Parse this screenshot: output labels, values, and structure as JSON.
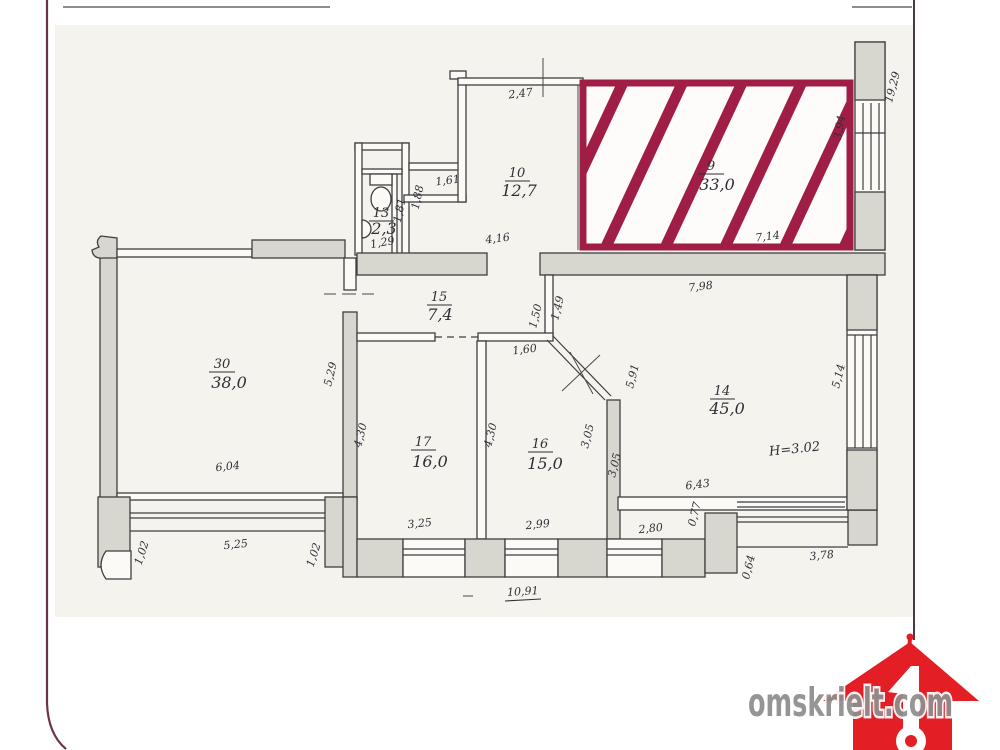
{
  "page": {
    "background": "#ffffff",
    "scan_background": "#f4f3ee"
  },
  "watermark": {
    "text": "omskrielt.com",
    "text_color": "#8e8e8e",
    "house_color": "#e31e24"
  },
  "plan": {
    "highlight_color": "#a01e46",
    "height_note": "H=3.02",
    "rooms": {
      "r9": {
        "number": "9",
        "area": "33,0"
      },
      "r10": {
        "number": "10",
        "area": "12,7"
      },
      "r13": {
        "number": "13",
        "area": "2,3"
      },
      "r15": {
        "number": "15",
        "area": "7,4"
      },
      "r30": {
        "number": "30",
        "area": "38,0"
      },
      "r17": {
        "number": "17",
        "area": "16,0"
      },
      "r16": {
        "number": "16",
        "area": "15,0"
      },
      "r14": {
        "number": "14",
        "area": "45,0"
      }
    },
    "dims": {
      "top_247": "2,47",
      "right_394": "3,94",
      "bottom_714": "7,14",
      "right_1929": "19,29",
      "niche_161": "1,61",
      "niche_188": "1,88",
      "wc_181": "1,81",
      "wc_129": "1,29",
      "hall_416": "4,16",
      "r14_798": "7,98",
      "wall_149": "1,49",
      "wall_150": "1,50",
      "hall_160": "1,60",
      "r14_591": "5,91",
      "r14_514": "5,14",
      "r30_529": "5,29",
      "r17_430l": "4,30",
      "r17_430r": "4,30",
      "r30_604": "6,04",
      "r16_305a": "3,05",
      "r16_305b": "3,05",
      "r14_643": "6,43",
      "r14_077": "0,77",
      "balc30_102l": "1,02",
      "balc30_525": "5,25",
      "balc30_102r": "1,02",
      "r17_325": "3,25",
      "r16_299": "2,99",
      "r14_280": "2,80",
      "balc14_064": "0,64",
      "balc14_378": "3,78",
      "total_1091": "10,91"
    }
  }
}
